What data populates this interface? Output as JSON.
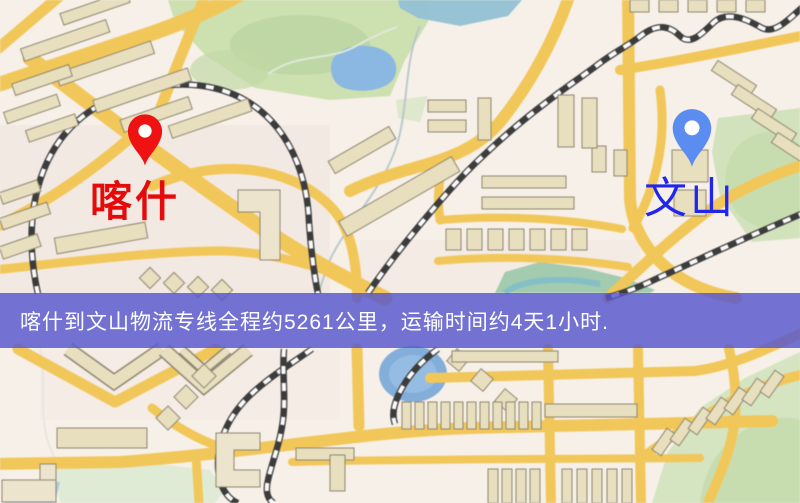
{
  "markers": {
    "origin": {
      "label": "喀什",
      "pin_color": "#ee1212",
      "pin_hole_color": "#ffffff",
      "label_color": "#e60b0b"
    },
    "destination": {
      "label": "文山",
      "pin_color": "#5b8cf0",
      "pin_hole_color": "#ffffff",
      "label_color": "#2125ee"
    }
  },
  "banner": {
    "text": "喀什到文山物流专线全程约5261公里，运输时间约4天1小时.",
    "background_color": "rgba(86,86,206,0.82)",
    "text_color": "#ffffff"
  },
  "route_info": {
    "origin": "喀什",
    "destination": "文山",
    "distance_km": "5261",
    "duration": "4天1小时"
  },
  "map_palette": {
    "background": "#f6f0e8",
    "road": "#f0c75e",
    "building": "#e8dfc0",
    "park": "#cde0b2",
    "water": "#8cb8e0",
    "railway": "#3c3c3c",
    "banner_overlay": "#5757cf"
  }
}
